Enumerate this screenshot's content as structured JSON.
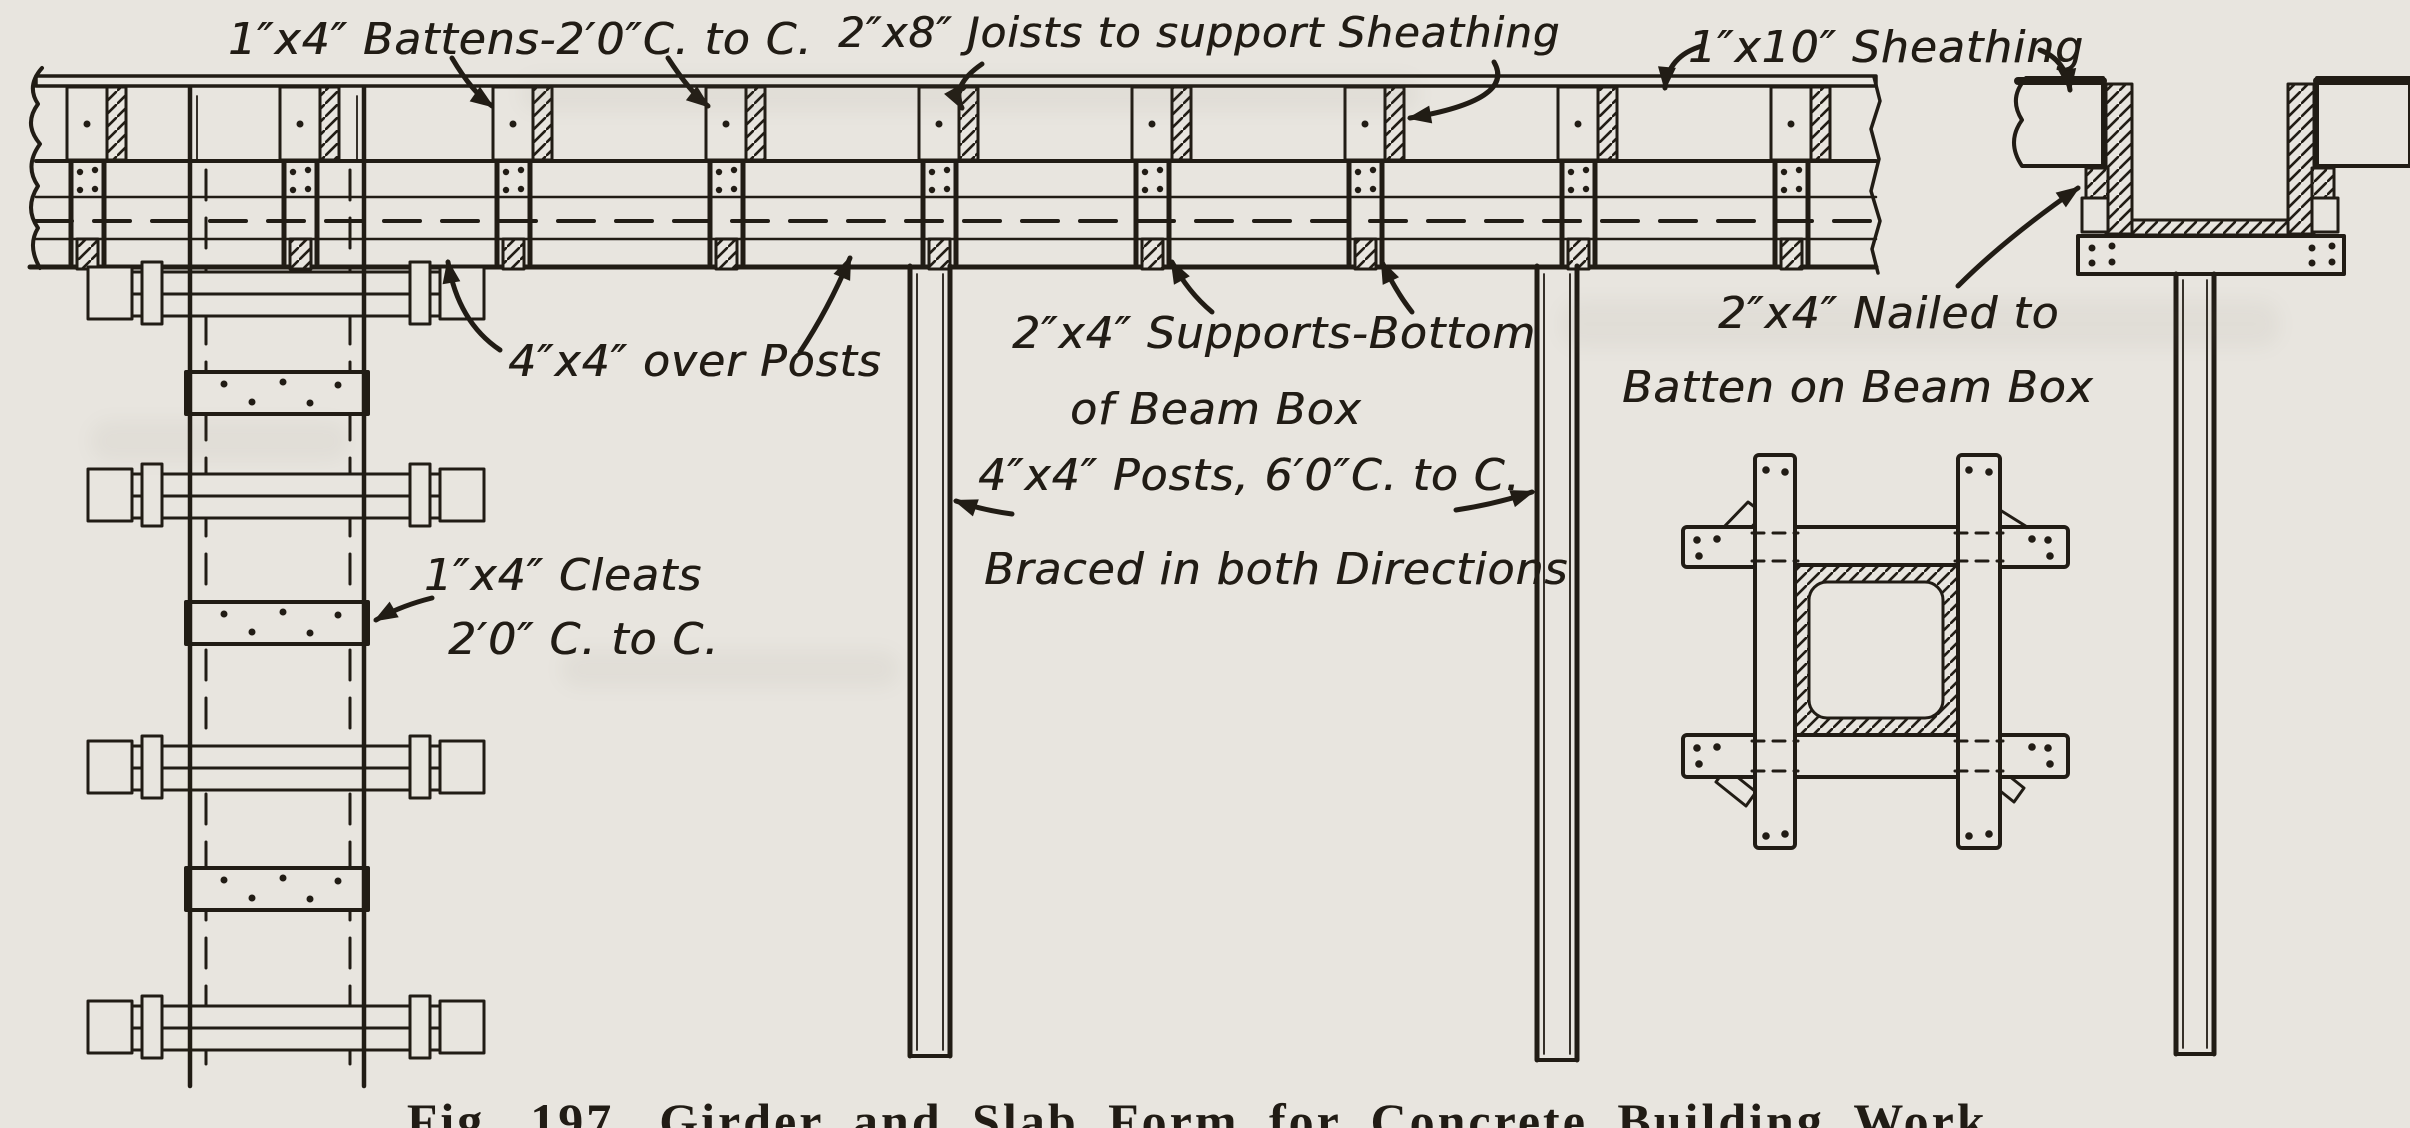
{
  "figure": {
    "caption": "Fig. 197.  Girder and Slab Form for Concrete Building Work.",
    "kind": "construction formwork section drawing"
  },
  "colors": {
    "paper": "#e8e5df",
    "ink": "#211c15"
  },
  "annotations": [
    {
      "id": "battens",
      "x": 228,
      "y": 14,
      "size": 44,
      "lh": 62,
      "lines": [
        {
          "text": "1″x4″ Battens-2′0″C. to C.",
          "dx": 0
        }
      ]
    },
    {
      "id": "joists",
      "x": 838,
      "y": 8,
      "size": 42,
      "lh": 62,
      "lines": [
        {
          "text": "2″x8″ Joists to support Sheathing",
          "dx": 0
        }
      ]
    },
    {
      "id": "sheathing",
      "x": 1688,
      "y": 22,
      "size": 44,
      "lh": 62,
      "lines": [
        {
          "text": "1″x10″ Sheathing",
          "dx": 0
        }
      ]
    },
    {
      "id": "over-posts",
      "x": 508,
      "y": 336,
      "size": 44,
      "lh": 62,
      "lines": [
        {
          "text": "4″x4″ over Posts",
          "dx": 0
        }
      ]
    },
    {
      "id": "supports",
      "x": 1012,
      "y": 308,
      "size": 44,
      "lh": 78,
      "lines": [
        {
          "text": "2″x4″ Supports-Bottom",
          "dx": 0
        },
        {
          "text": "of Beam Box",
          "dx": 58
        }
      ]
    },
    {
      "id": "nailed",
      "x": 1622,
      "y": 288,
      "size": 44,
      "lh": 76,
      "lines": [
        {
          "text": "2″x4″ Nailed to",
          "dx": 96
        },
        {
          "text": "Batten on Beam Box",
          "dx": 0
        }
      ]
    },
    {
      "id": "posts-braced",
      "x": 978,
      "y": 450,
      "size": 44,
      "lh": 96,
      "lines": [
        {
          "text": "4″x4″ Posts, 6′0″C. to C.",
          "dx": 0
        },
        {
          "text": "Braced in both Directions",
          "dx": 6
        }
      ]
    },
    {
      "id": "cleats",
      "x": 424,
      "y": 550,
      "size": 44,
      "lh": 66,
      "lines": [
        {
          "text": "1″x4″ Cleats",
          "dx": 0
        },
        {
          "text": "2′0″ C. to C.",
          "dx": 24
        }
      ]
    }
  ]
}
